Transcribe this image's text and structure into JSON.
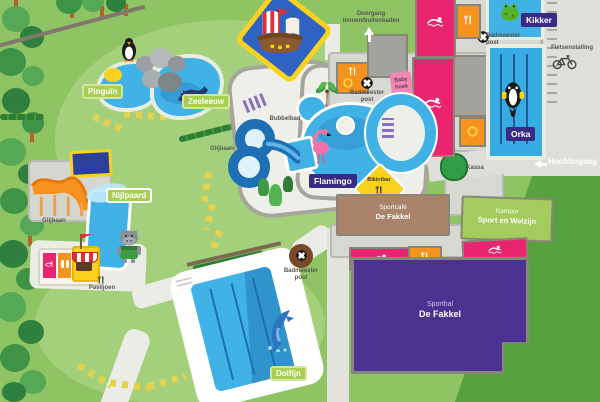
{
  "map_title": "Zwembad De Fakkel plattegrond",
  "pools": {
    "pinguin": "Pinguïn",
    "zeeleeuw": "Zeeleeuw",
    "kikker": "Kikker",
    "orka": "Orka",
    "nijlpaard": "Nijlpaard",
    "flamingo": "Flamingo",
    "dolfijn": "Dolfijn"
  },
  "labels": {
    "doorgang_line1": "Doorgang",
    "doorgang_line2": "binnen/buitenbaden",
    "badmeester_line1": "Badmeester",
    "badmeester_line2": "post",
    "fietsenstalling": "Fietsenstalling",
    "hoofdingang": "Hoofdingang",
    "kassa": "Kassa",
    "baby_line1": "Baby",
    "baby_line2": "hoek",
    "bubbelbad": "Bubbelbad",
    "glijbaan": "Glijbaan",
    "bikinibar": "Bikinibar",
    "paviljoen": "Paviljoen"
  },
  "buildings": {
    "sportcafe_line1": "Sportcafé",
    "sportcafe_line2": "De Fakkel",
    "kantoor_line1": "Kantoor",
    "kantoor_line2": "Sport en Welzijn",
    "sporthal_line1": "Sporthal",
    "sporthal_line2": "De Fakkel"
  },
  "icons": [
    "swimmer-icon",
    "utensils-icon",
    "lifebuoy-icon",
    "sun-icon",
    "bicycle-icon",
    "up-arrow-icon",
    "left-arrow-icon",
    "penguin-icon",
    "sealion-icon",
    "frog-icon",
    "orca-icon",
    "flamingo-icon",
    "hippo-icon",
    "dolphin-icon",
    "pirate-ship-icon",
    "palm-tree-icon",
    "slide-loop-icon",
    "water-slide-icon",
    "flag-icon",
    "baby-icon",
    "kassa-bush"
  ],
  "colors": {
    "grass": "#8ec463",
    "grass_light": "#a4d07c",
    "dark_green": "#57a23e",
    "forest_green": "#3e9347",
    "pool_blue": "#41b2e6",
    "pool_deep": "#2f93cc",
    "lane_navy": "#1b5d8f",
    "magenta": "#e8256e",
    "orange": "#f6921e",
    "purple_label": "#3b2a84",
    "sporthal_purple": "#4b3190",
    "label_green": "#a8cf52",
    "cafe_brown": "#a9846a",
    "kantoor_green": "#a3cb5e",
    "yellow": "#f9d21e",
    "path_light": "#ecece6",
    "concourse": "#d8d8d3",
    "pirate_blue": "#2e62c3",
    "baby_pink": "#ef86b5",
    "text_gray": "#575750"
  }
}
